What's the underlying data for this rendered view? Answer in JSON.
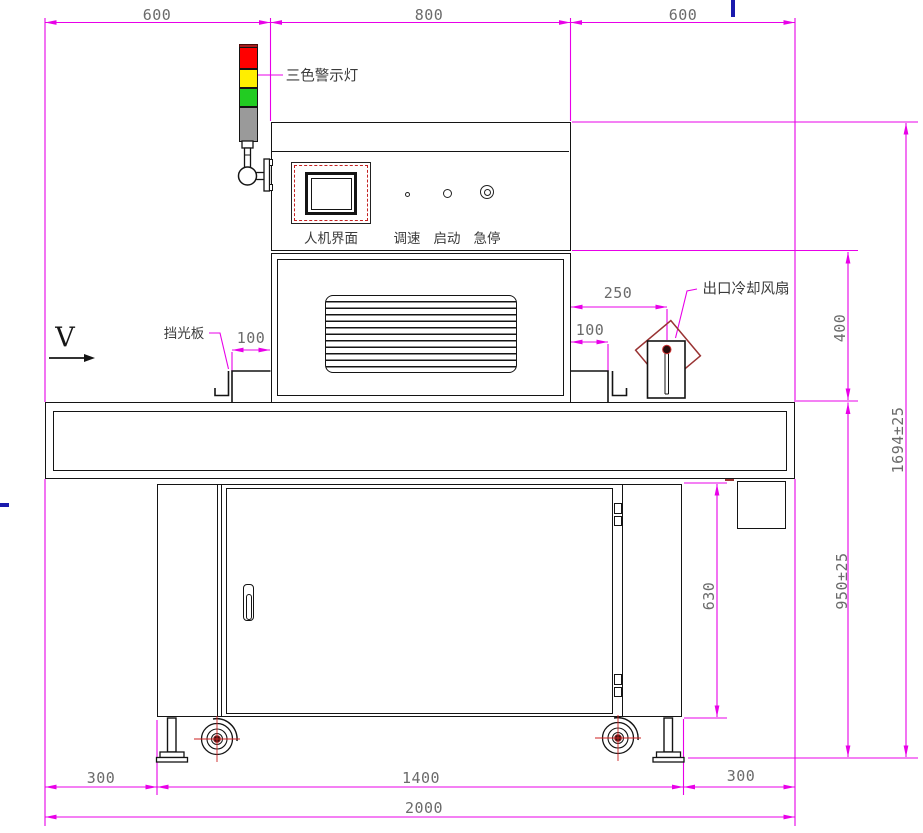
{
  "drawing": {
    "machine_labels": {
      "warning_light": "三色警示灯",
      "hmi_screen": "人机界面",
      "speed_knob": "调速",
      "start_button": "启动",
      "estop_button": "急停",
      "light_shield": "挡光板",
      "outlet_fan": "出口冷却风扇",
      "flow_direction": "V"
    },
    "dimensions": {
      "top_left_600": "600",
      "top_middle_800": "800",
      "top_right_600": "600",
      "shield_offset_left_100": "100",
      "shield_offset_right_100": "100",
      "fan_offset_250": "250",
      "hood_height_400": "400",
      "overall_height": "1694±25",
      "belt_height": "950±25",
      "cabinet_height_630": "630",
      "bottom_left_300": "300",
      "bottom_middle_1400": "1400",
      "bottom_right_300": "300",
      "overall_width_2000": "2000"
    },
    "colors": {
      "dimension_line": "#e800e8",
      "outline": "#141414",
      "warning_red": "#ff0000",
      "warning_yellow": "#ffee00",
      "warning_green": "#22cc22",
      "warning_gray": "#9a9a9a",
      "accent_dark_red": "#993333",
      "blue_mark": "#1a1aad"
    }
  }
}
